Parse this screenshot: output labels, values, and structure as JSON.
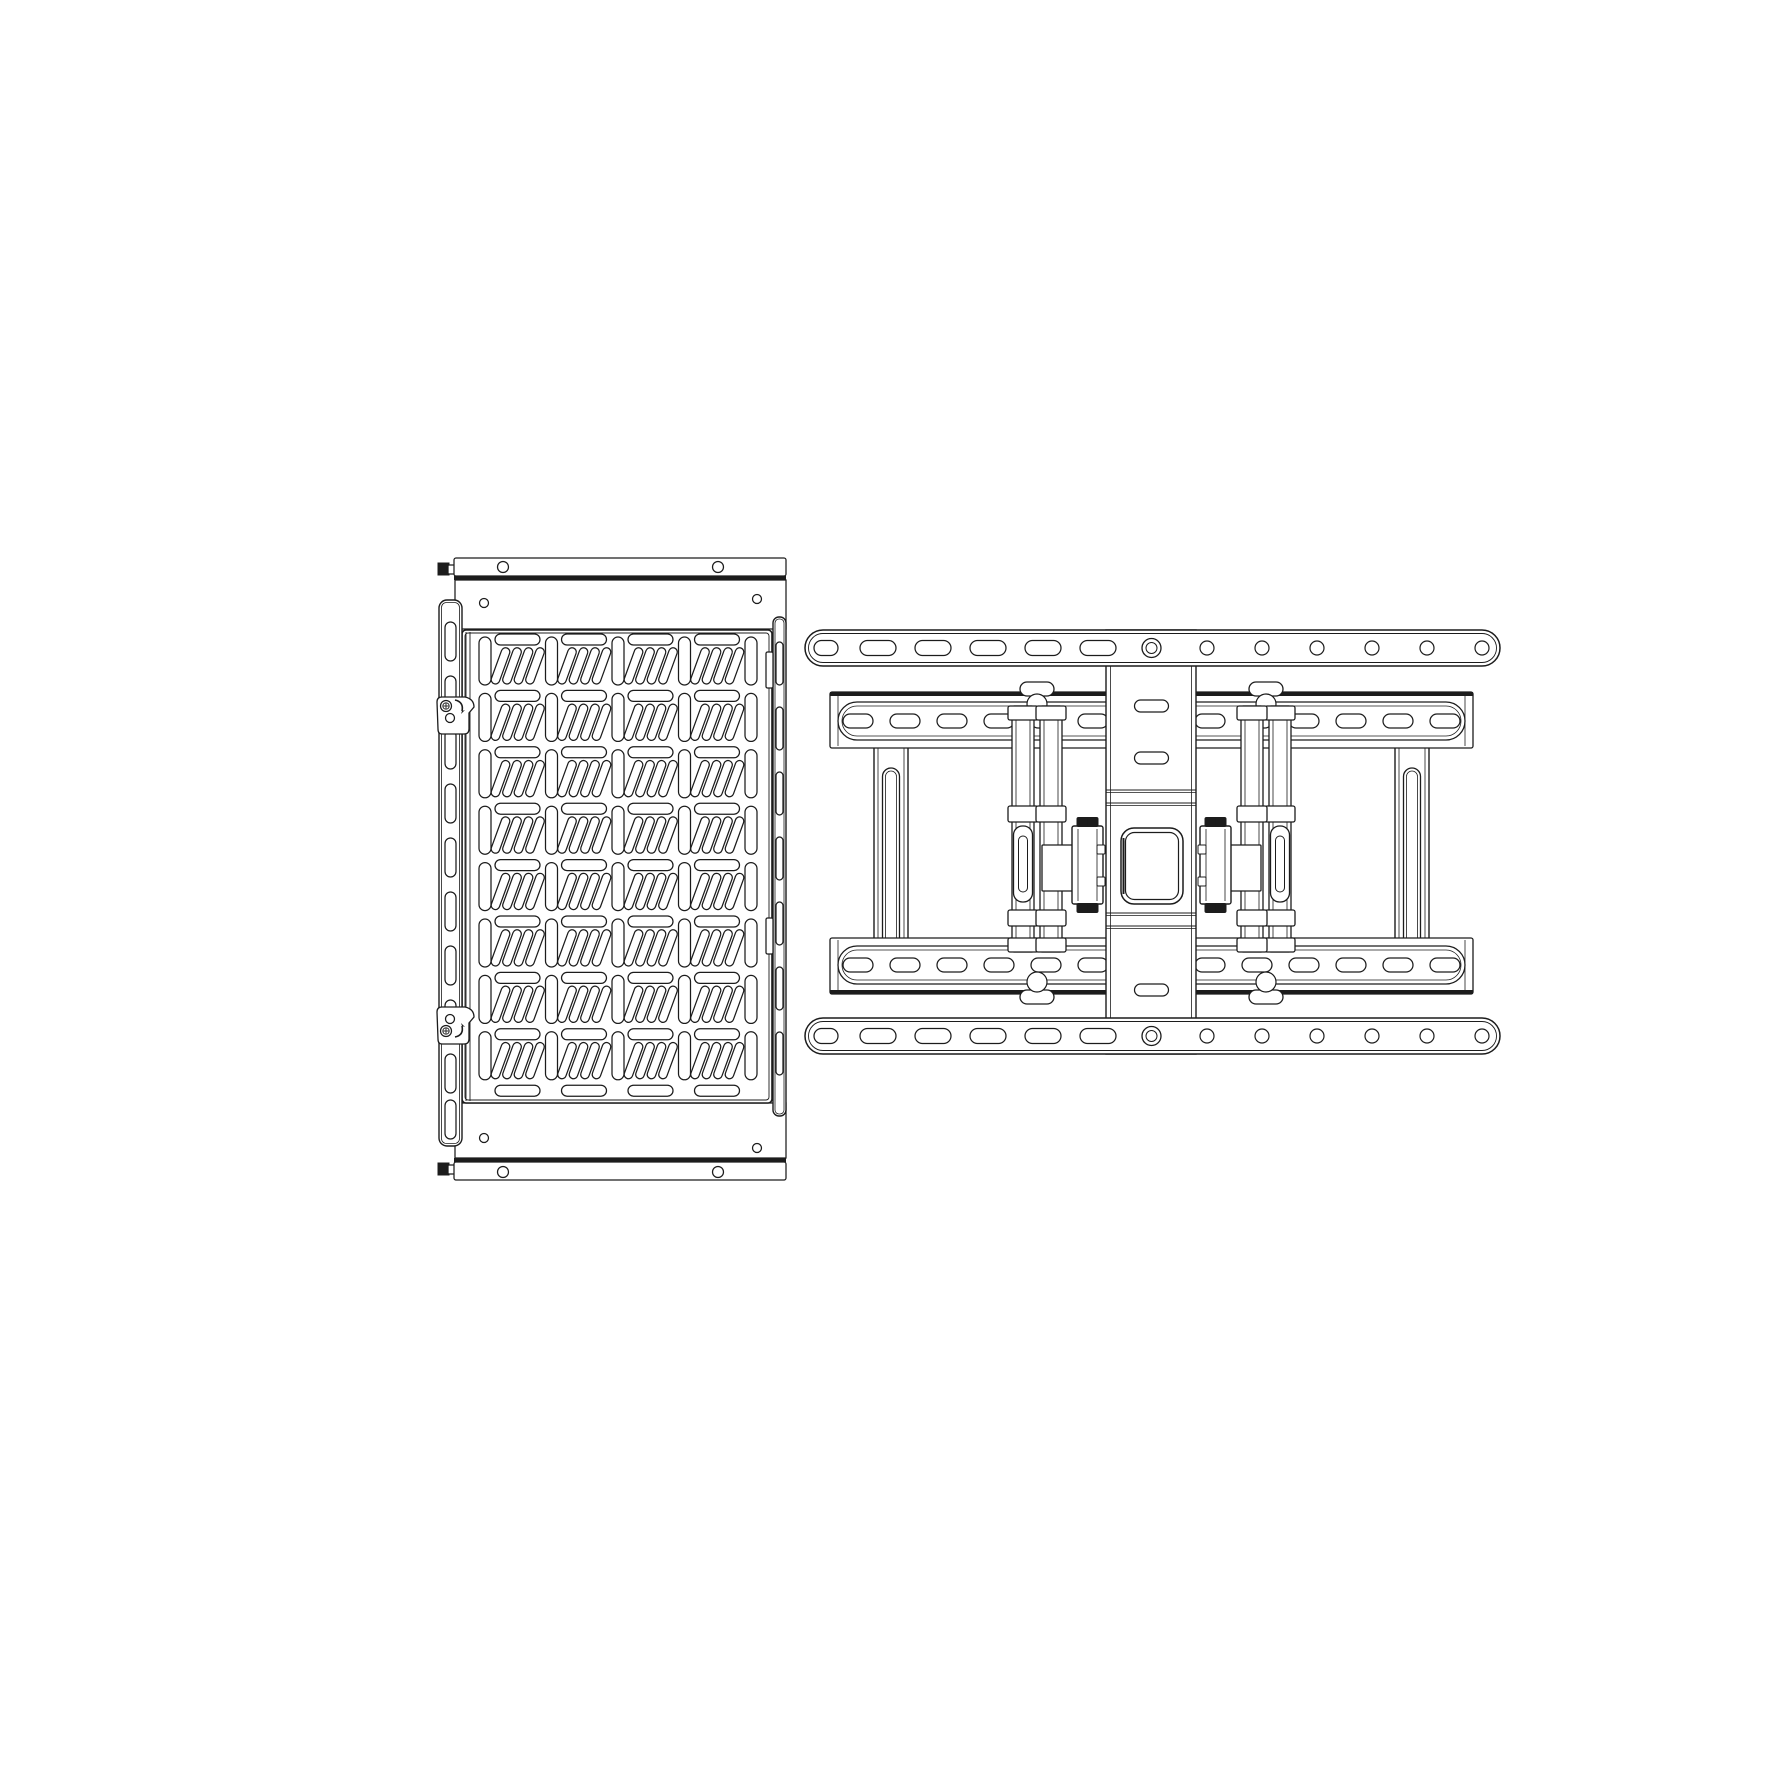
{
  "page": {
    "background": "#ffffff",
    "stroke": "#1c1c1c",
    "width": 1774,
    "height": 1774,
    "description": "Black-and-white technical line drawing: slotted vent cover plate (left) and articulating full-motion TV wall-mount bracket (right)"
  },
  "drawing": {
    "vent_panel": {
      "strip_top": {
        "x": 454,
        "y": 558,
        "w": 332,
        "h": 18,
        "holes": [
          [
            503,
            567
          ],
          [
            718,
            567
          ]
        ],
        "hole_r": 5.5
      },
      "dark_band_top": {
        "x": 454,
        "y": 576,
        "w": 332,
        "h": 4
      },
      "strip2_top": {
        "x": 455,
        "y": 580,
        "w": 331,
        "h": 49,
        "holes": [
          [
            484,
            603
          ],
          [
            757,
            599
          ]
        ],
        "hole_r": 4.5
      },
      "panel": {
        "x": 462,
        "y": 630,
        "w": 310,
        "h": 473
      },
      "hinge_lines_x": [
        466,
        470
      ],
      "grid": {
        "first_pill_y": 634,
        "row_pitch": 56.4,
        "pill_rows": 9,
        "diag_rows": 8,
        "pill_xs": [
          495,
          561.5,
          628,
          694.5
        ],
        "pill_w": 45,
        "pill_h": 11,
        "vslot_cx": [
          485,
          551.5,
          618,
          684.5,
          751
        ],
        "vslot_w": 12,
        "vslot_h": 48,
        "diag_per_cell": 4,
        "diag_w": 8.5,
        "diag_h": 38,
        "diag_angle": 20,
        "diag_pitch": 11.5,
        "diag_x0": 12
      },
      "left_rail": {
        "x": 439,
        "y": 600,
        "w": 23,
        "h": 546,
        "r": 8,
        "slot_cx": 450.5,
        "slot_w": 11,
        "slot_h": 39,
        "slot_ys": [
          622,
          676,
          730,
          784,
          838,
          892,
          946,
          1000,
          1054,
          1100
        ]
      },
      "clamps": [
        {
          "x": 437,
          "y": 697,
          "w": 31,
          "h": 32,
          "screw": [
            446,
            706
          ],
          "pin": [
            450,
            718
          ],
          "arrow_up": false
        },
        {
          "x": 437,
          "y": 1007,
          "w": 31,
          "h": 32,
          "screw": [
            446,
            1031
          ],
          "pin": [
            450,
            1019
          ],
          "arrow_up": true
        }
      ],
      "right_rail": {
        "x": 773,
        "y": 617,
        "w": 13,
        "h": 499,
        "r": 6,
        "slot_cx": 779.5,
        "slot_w": 7,
        "slot_h": 43,
        "slot_ys": [
          642,
          707,
          772,
          837,
          902,
          967,
          1032
        ],
        "tab_x": 766,
        "tab_w": 7,
        "tab_h": 36,
        "tab_ys": [
          652,
          918
        ]
      },
      "strip2_bottom": {
        "x": 455,
        "y": 1103,
        "w": 331,
        "h": 55,
        "holes": [
          [
            484,
            1138
          ],
          [
            757,
            1148
          ]
        ],
        "hole_r": 4.5
      },
      "dark_band_bottom": {
        "x": 454,
        "y": 1158,
        "w": 332,
        "h": 4
      },
      "strip_bottom": {
        "x": 454,
        "y": 1162,
        "w": 332,
        "h": 18,
        "holes": [
          [
            503,
            1172
          ],
          [
            718,
            1172
          ]
        ],
        "hole_r": 5.5
      },
      "bolts": [
        [
          438,
          563
        ],
        [
          438,
          1163
        ]
      ]
    },
    "tv_mount": {
      "cx": 1151.5,
      "bar": {
        "x": 805,
        "w": 695,
        "h": 36,
        "r": 18,
        "oblong_cx": [
          826,
          878,
          933,
          988,
          1043,
          1098
        ],
        "oblong_w": [
          24,
          36,
          36,
          36,
          36,
          36
        ],
        "oblong_h": 15,
        "ring_r_outer": 9.5,
        "ring_r_inner": 5.5,
        "circle_cx": [
          1207,
          1262,
          1317,
          1372,
          1427,
          1482
        ],
        "circle_r": 7
      },
      "bar_ys": [
        630,
        1018
      ],
      "rail": {
        "x": 830,
        "w": 643,
        "h": 56,
        "channel_inset": 10,
        "channel_h": 38,
        "channel_r": 19,
        "hole_cx": [
          858,
          905,
          952,
          999,
          1046,
          1093,
          1210,
          1257,
          1304,
          1351,
          1398,
          1445
        ],
        "hole_w": 30,
        "hole_h": 14,
        "tab_cx": [
          1037,
          1266
        ],
        "tab_w": 34,
        "tab_h": 14,
        "pin_r": 10
      },
      "rail_ys": [
        692,
        938
      ],
      "side_plate": {
        "x": 874,
        "y": 697,
        "w": 34,
        "h": 292,
        "slot_dx": 8.5,
        "slot_y": 768,
        "slot_w": 17,
        "slot_h": 184
      },
      "links": {
        "outer_x": 1012,
        "inner_x": 1040,
        "bar_w": 22,
        "top_y": 706,
        "bot_y": 952,
        "collars": [
          [
            706,
            14
          ],
          [
            806,
            16
          ],
          [
            910,
            16
          ],
          [
            938,
            14
          ]
        ],
        "frame_y": 826,
        "frame_h": 76,
        "slot_y": 836,
        "slot_h": 56
      },
      "clamp": {
        "block_x": 1072,
        "block_w": 31,
        "block_y": 826,
        "block_h": 78,
        "arm_x": 1042,
        "arm_w": 31,
        "arm_y": 845,
        "arm_h": 46,
        "bolt_w": 22,
        "bolt_h": 10,
        "clip_dy": [
          19,
          51
        ],
        "clip_h": 9,
        "clip_w": 8
      },
      "column": {
        "x": 1106,
        "y": 630,
        "w": 90,
        "h": 424,
        "fold_ys": [
          790,
          803,
          913,
          926
        ],
        "oblong_cy": [
          706,
          758,
          990
        ],
        "oblong_w": 34,
        "oblong_h": 12
      },
      "center_plate": {
        "x": 1121,
        "y": 828,
        "w": 62,
        "h": 76,
        "r": 13,
        "inset": 4.5
      }
    }
  }
}
